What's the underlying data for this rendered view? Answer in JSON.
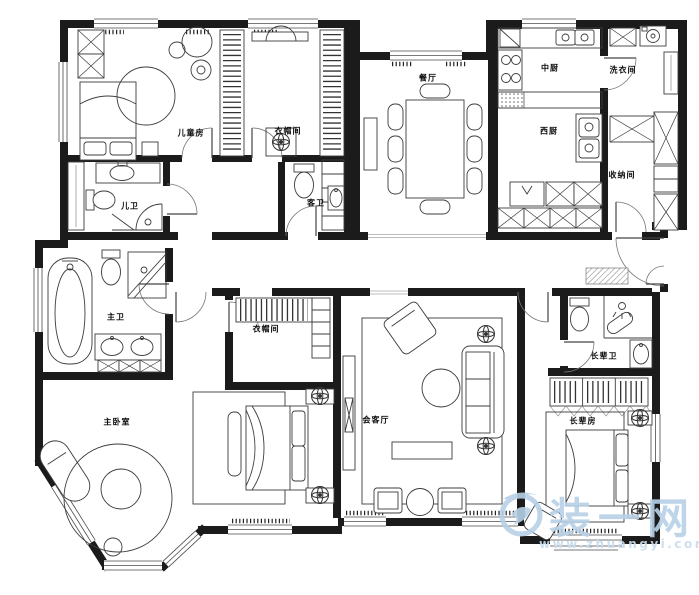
{
  "rooms": [
    {
      "id": "children-room",
      "label": "儿童房"
    },
    {
      "id": "cloakroom-north",
      "label": "衣帽间"
    },
    {
      "id": "dining-room",
      "label": "餐厅"
    },
    {
      "id": "chinese-kitchen",
      "label": "中厨"
    },
    {
      "id": "laundry-room",
      "label": "洗衣间"
    },
    {
      "id": "western-kitchen",
      "label": "西厨"
    },
    {
      "id": "storage-room",
      "label": "收纳间"
    },
    {
      "id": "children-bath",
      "label": "儿卫"
    },
    {
      "id": "guest-bath",
      "label": "客卫"
    },
    {
      "id": "master-bath",
      "label": "主卫"
    },
    {
      "id": "cloakroom-master",
      "label": "衣帽间"
    },
    {
      "id": "master-bedroom",
      "label": "主卧室"
    },
    {
      "id": "living-room",
      "label": "会客厅"
    },
    {
      "id": "elder-bath",
      "label": "长辈卫"
    },
    {
      "id": "elder-room",
      "label": "长辈房"
    }
  ],
  "watermark": {
    "brand": "装一网",
    "url": "www.zhuangyi.com",
    "color": "#b7d1e7"
  },
  "colors": {
    "wall": "#1b1b1b",
    "furniture_line": "#3c3c3c",
    "background": "#ffffff"
  }
}
